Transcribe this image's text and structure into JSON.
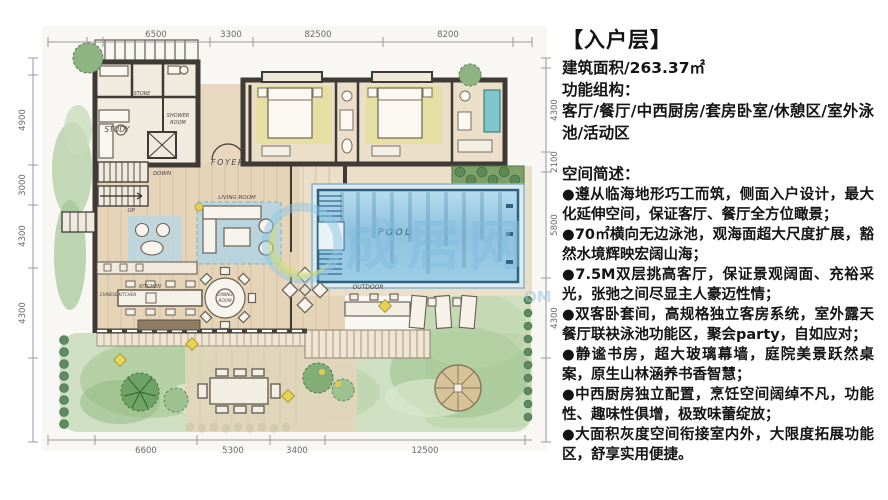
{
  "panel": {
    "title": "【入户层】",
    "area": "建筑面积/263.37㎡",
    "function_heading": "功能组构：",
    "function_list": "客厅/餐厅/中西厨房/套房卧室/休憩区/室外泳池/活动区",
    "brief_heading": "空间简述：",
    "bullets": [
      "●遵从临海地形巧工而筑，侧面入户设计，最大化延伸空间，保证客厅、餐厅全方位瞰景；",
      "●70㎡横向无边泳池，观海面超大尺度扩展，豁然水境辉映宏阔山海；",
      "●7.5M双层挑高客厅，保证景观阔面、充裕采光，张弛之间尽显主人豪迈性情；",
      "●双客卧套间，高规格独立客房系统，室外露天餐厅联袂泳池功能区，聚会party，自如应对；",
      "●静谧书房，超大玻璃幕墙，庭院美景跃然桌案，原生山林涵养书香智慧；",
      "●中西厨房独立配置，烹饪空间阔绰不凡，功能性、趣味性俱增，极致味蕾绽放；",
      "●大面积灰度空间衔接室内外，大限度拓展功能区，舒享实用便捷。"
    ]
  },
  "plan": {
    "dims_top": [
      "6500",
      "3300",
      "82500",
      "8200"
    ],
    "dims_bottom": [
      "6600",
      "5300",
      "3400",
      "12500"
    ],
    "dims_left": [
      "4900",
      "3000",
      "4300",
      "4300"
    ],
    "dims_right": [
      "4300",
      "2100",
      "5800",
      "4300"
    ],
    "rooms": {
      "study": "STUDY",
      "store": "STORE",
      "shower_line1": "SHOWER",
      "shower_line2": "ROOM",
      "foyer": "FOYER",
      "down": "DOWN",
      "up": "UP",
      "living_room": "LIVING ROOM",
      "dining_line1": "DINING",
      "dining_line2": "ROOM",
      "kitchen": "KITCHEN",
      "chinese_kitchen": "CHINESE KITCHEN",
      "outdoor": "OUTDOOR",
      "pool": "POOL"
    },
    "watermark": {
      "text": "成居网",
      "suffix": "OM"
    }
  }
}
